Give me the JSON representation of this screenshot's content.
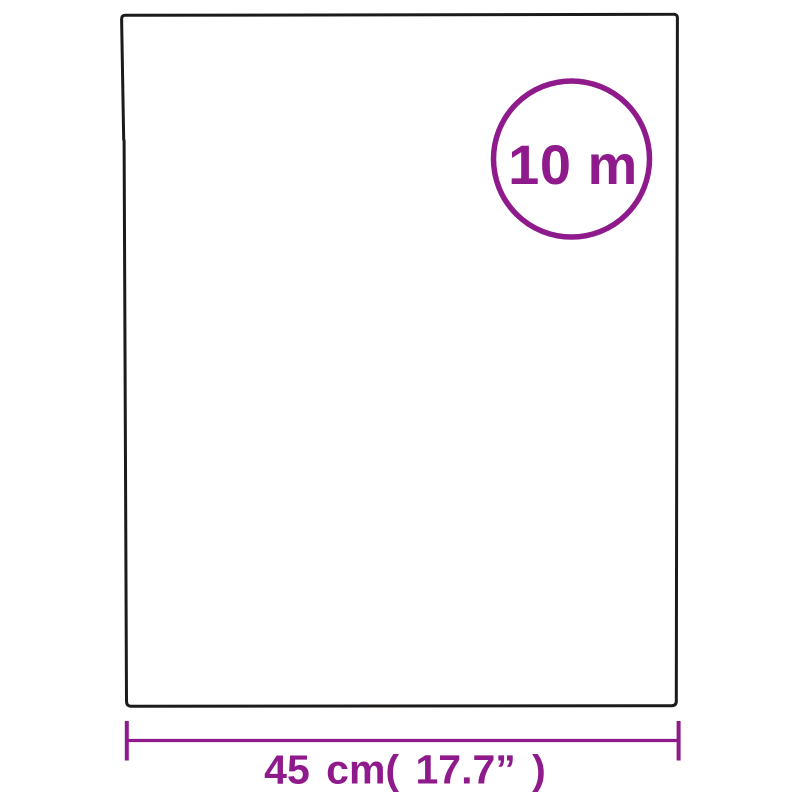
{
  "colors": {
    "accent": "#8E1A8C",
    "ink": "#1D1B1A",
    "background": "#FFFFFF"
  },
  "diagram": {
    "length_badge": {
      "label": "10 m"
    },
    "width_dimension": {
      "label": "45 cm( 17.7” )"
    }
  }
}
